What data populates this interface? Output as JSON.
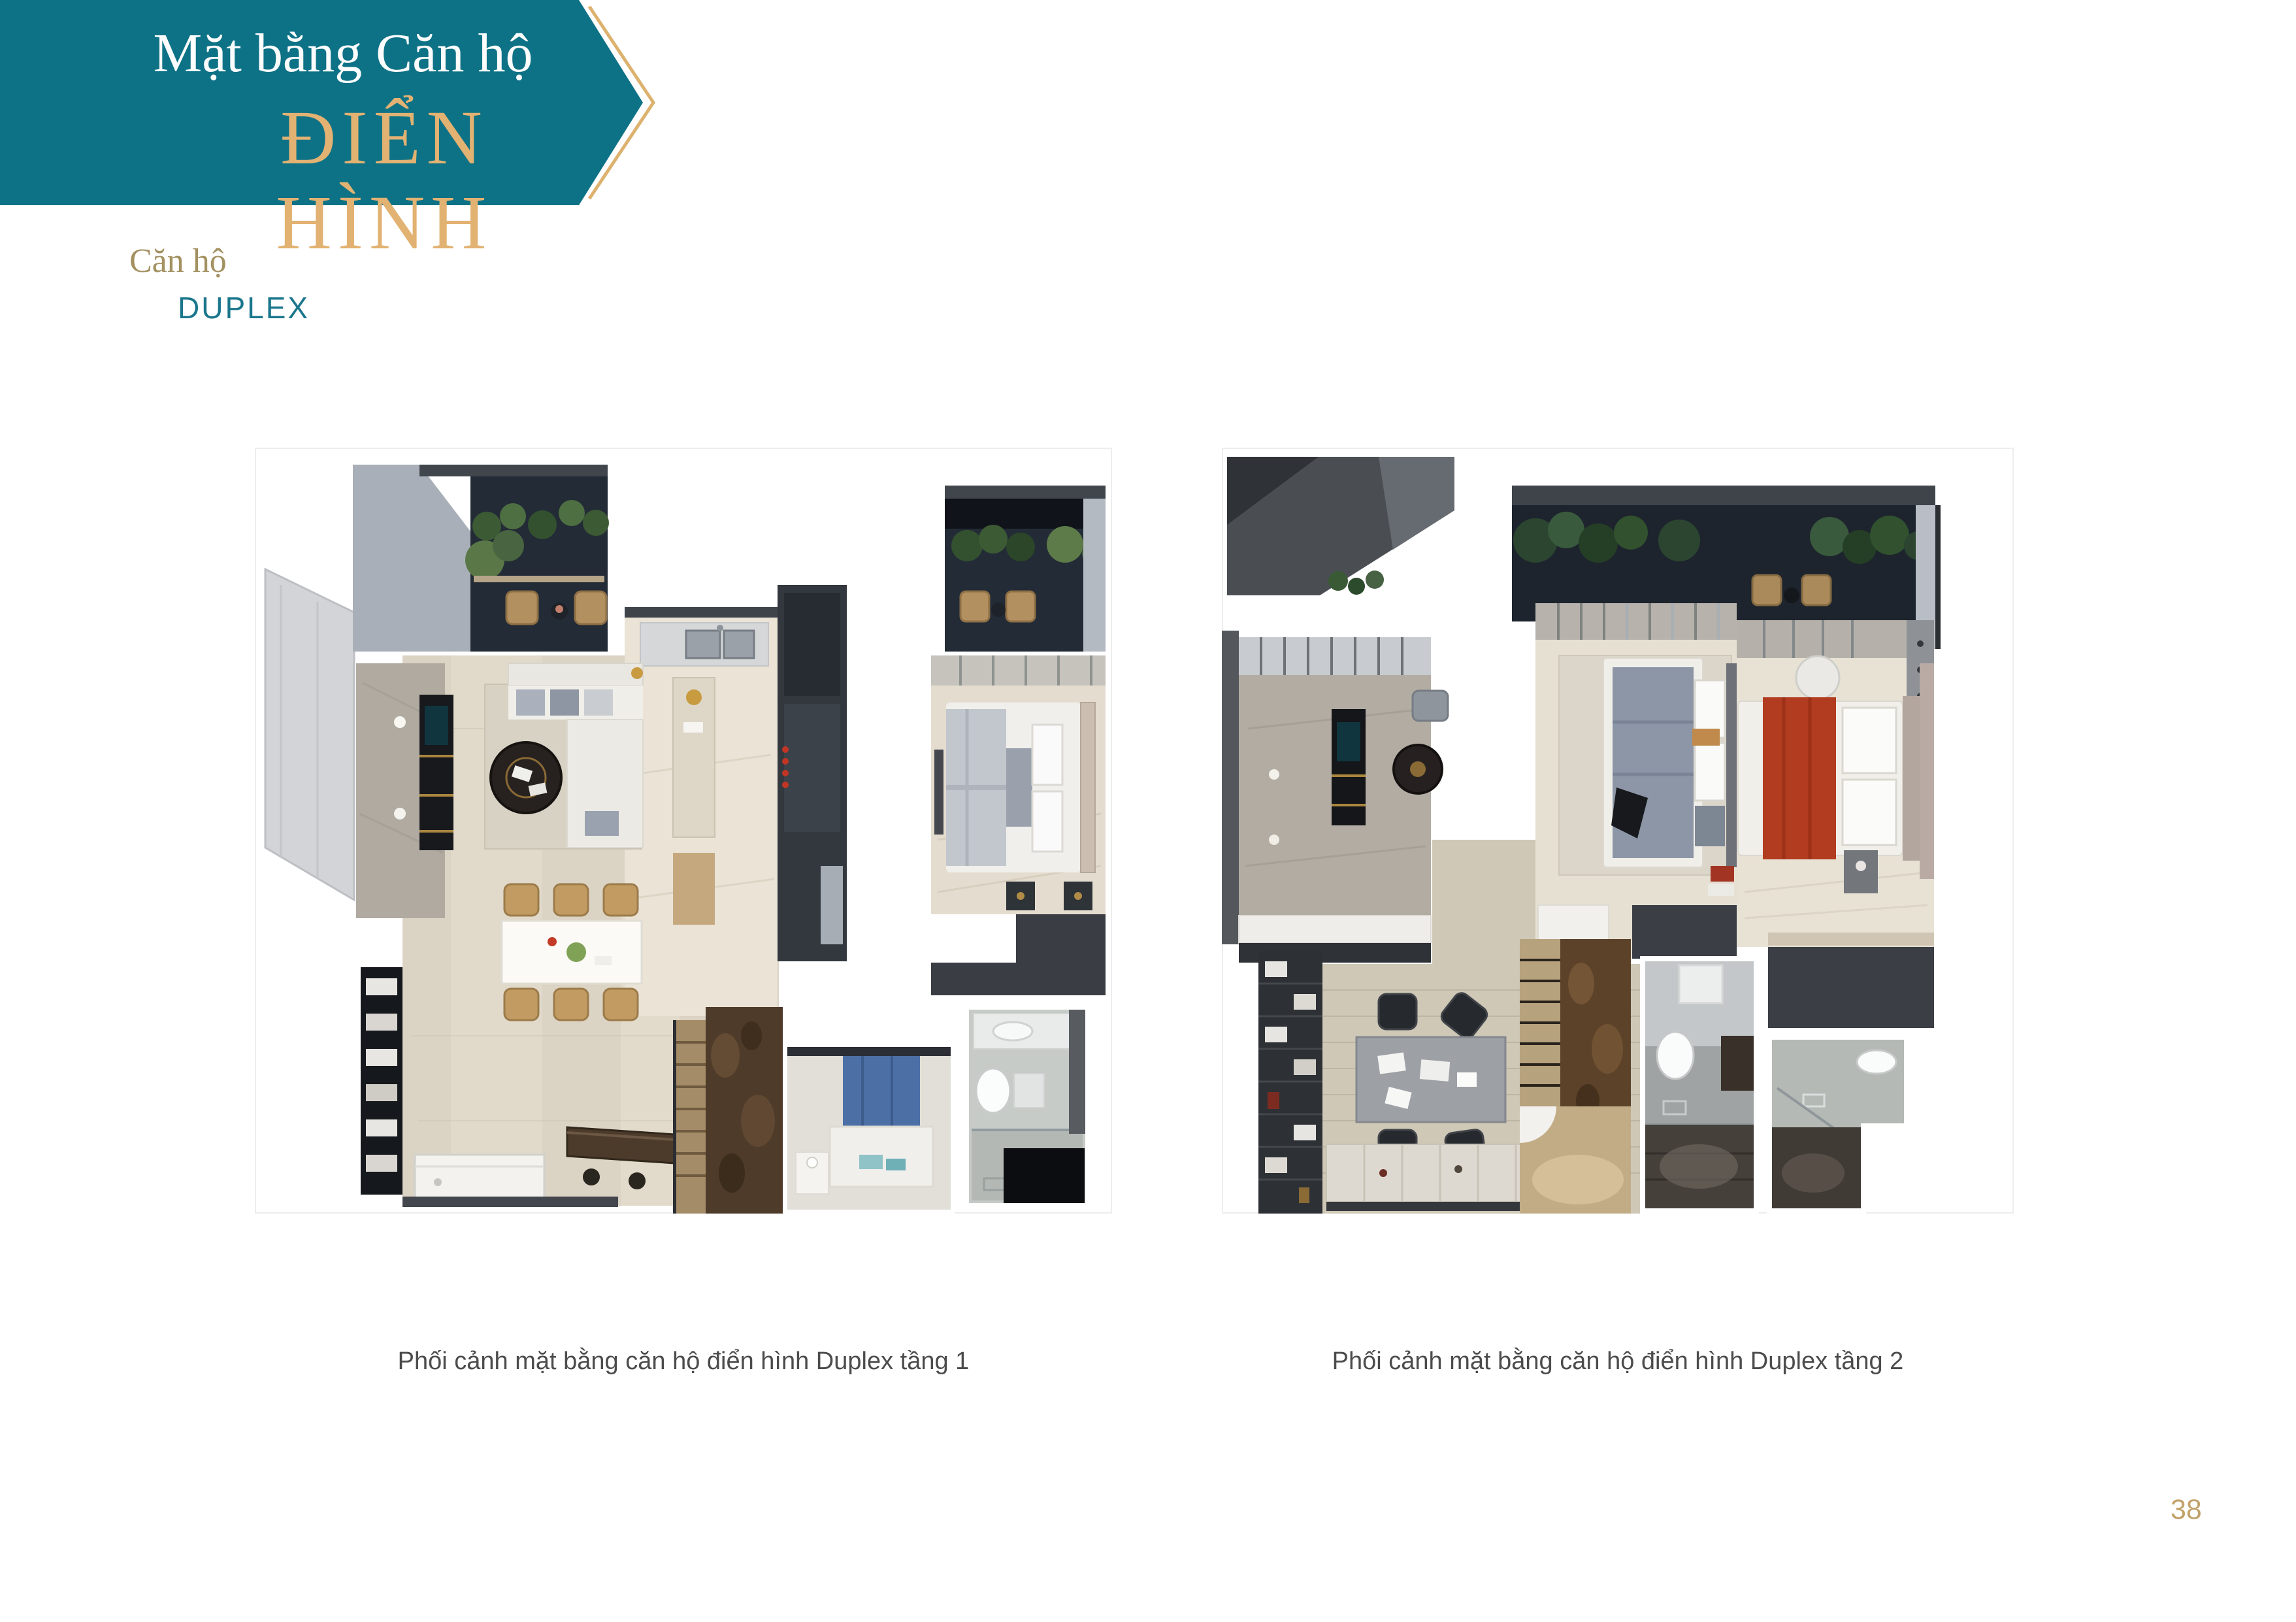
{
  "banner": {
    "title_top": "Mặt bằng Căn hộ",
    "title_main": "ĐIỂN HÌNH",
    "bg_color": "#0e7286",
    "accent_color": "#ddb26f",
    "text_color": "#fdfdfd"
  },
  "subtitle": {
    "prefix": "Căn hộ",
    "type": "DUPLEX",
    "prefix_color": "#a39161",
    "type_color": "#1a768c"
  },
  "floorplans": [
    {
      "id": "duplex-tang-1",
      "caption": "Phối cảnh mặt bằng căn hộ điển hình Duplex tầng 1"
    },
    {
      "id": "duplex-tang-2",
      "caption": "Phối cảnh mặt bằng căn hộ điển hình Duplex tầng 2"
    }
  ],
  "footer": {
    "page_number": "38",
    "page_number_color": "#c2a269"
  },
  "caption_color": "#4c4c4c"
}
